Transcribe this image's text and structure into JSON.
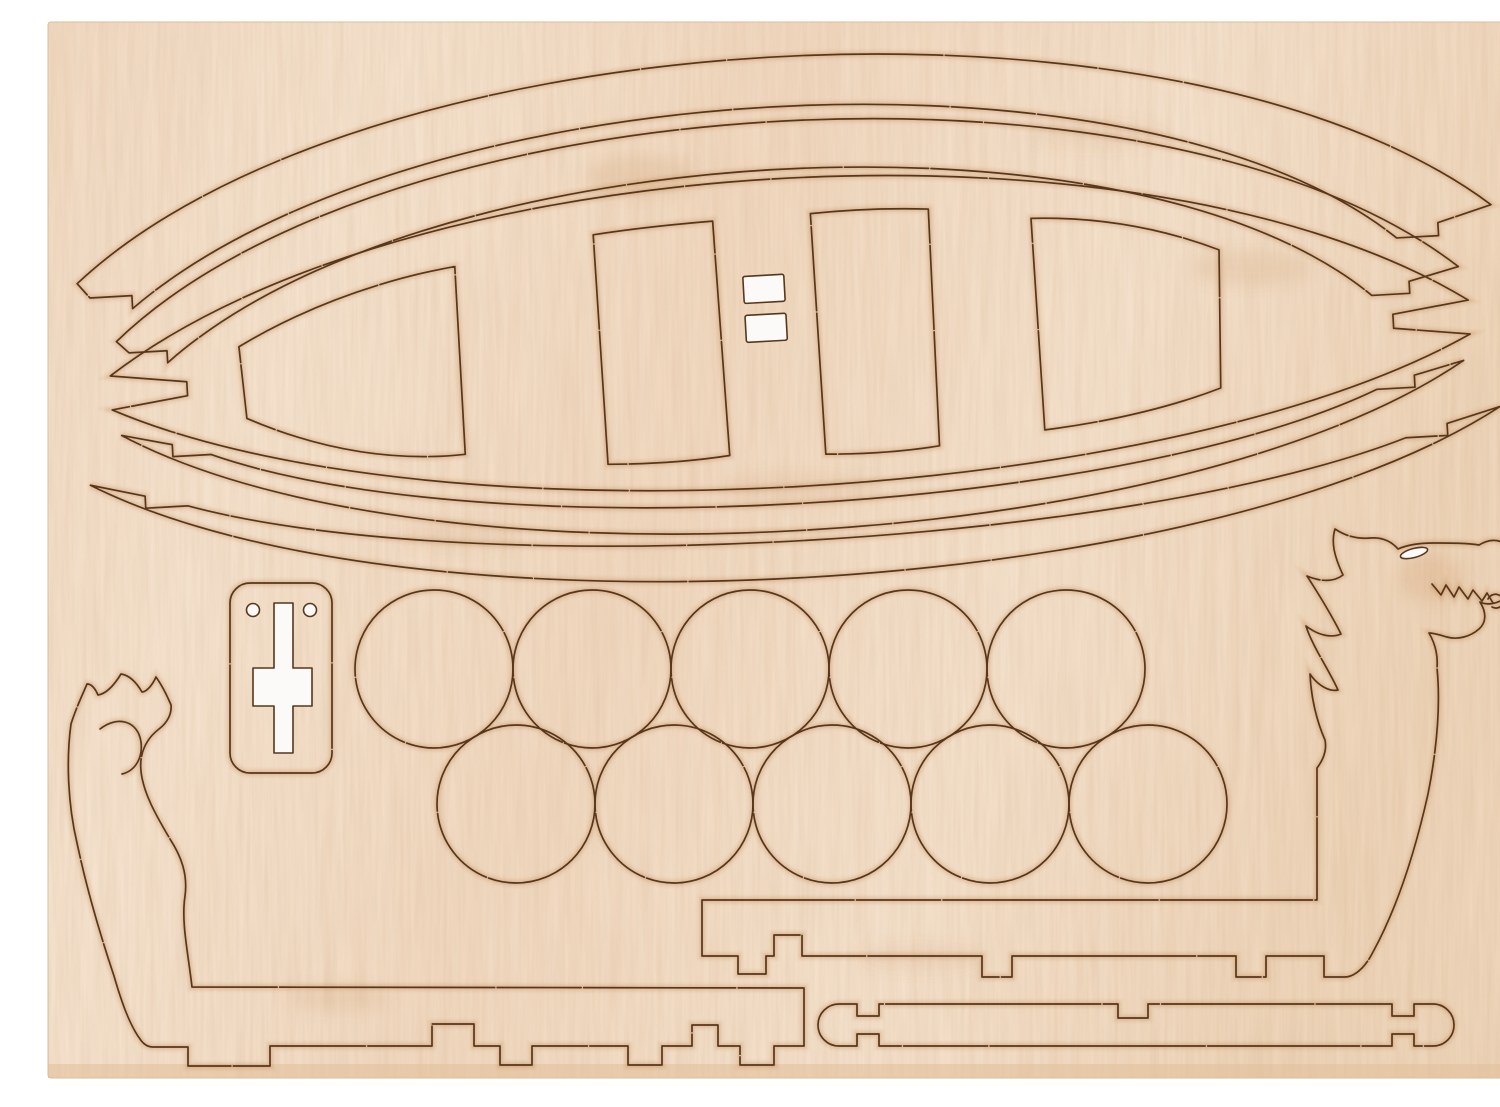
{
  "meta": {
    "description": "Photograph of a light beech laser-cut plywood sheet on a white background containing press-out parts for a Viking dragon boat model kit: four curved gunwale strips and a lens-shaped hull deck with four plank cutlines and two small punched mast slots at top, ten round shield discs in two rows of five, a rudder mount plate with a white cross cutout and two pilot holes, a curled dragon tail stem piece on the left and a dragon head stem piece with eye slit and zigzag teeth cuts on the right, plus notched keel strips and a barbell-ended mast strip along the bottom."
  },
  "colors": {
    "background": "#ffffff",
    "wood_base": "#f3dcc3",
    "wood_light": "#f9ecd9",
    "wood_dark": "#eccfae",
    "wood_edge": "#e2bf99",
    "cut_line": "#58361c",
    "scorch": "#a96a30",
    "scorch_light": "#c98f58",
    "cutout_white": "#fbfaf8"
  },
  "parts": {
    "hull_deck": {
      "name": "hull deck (lens shape with forked ends)",
      "plank_cutlines": 4,
      "mast_slots": 2
    },
    "gunwale_strips": {
      "count": 4,
      "arrangement": "two curved strips above and two below the deck, pointed notched tips"
    },
    "shield_discs": {
      "count": 10,
      "rows": [
        5,
        5
      ],
      "approx_diameter_px": 158
    },
    "rudder_plate": {
      "count": 1,
      "pilot_holes": 2,
      "through_cutout": "cross"
    },
    "dragon_head": {
      "count": 1,
      "position": "right",
      "through_cutouts": [
        "eye slit"
      ],
      "cut_details": [
        "zigzag teeth",
        "nostril curl",
        "four mane spikes"
      ],
      "attached": "notched keel strip"
    },
    "dragon_tail": {
      "count": 1,
      "position": "left",
      "cut_details": [
        "flame-spike crest",
        "inner curl"
      ],
      "attached": "notched keel strip with feet tabs"
    },
    "barbell_strip": {
      "count": 1,
      "ends": "rounded caps with side notches"
    }
  }
}
